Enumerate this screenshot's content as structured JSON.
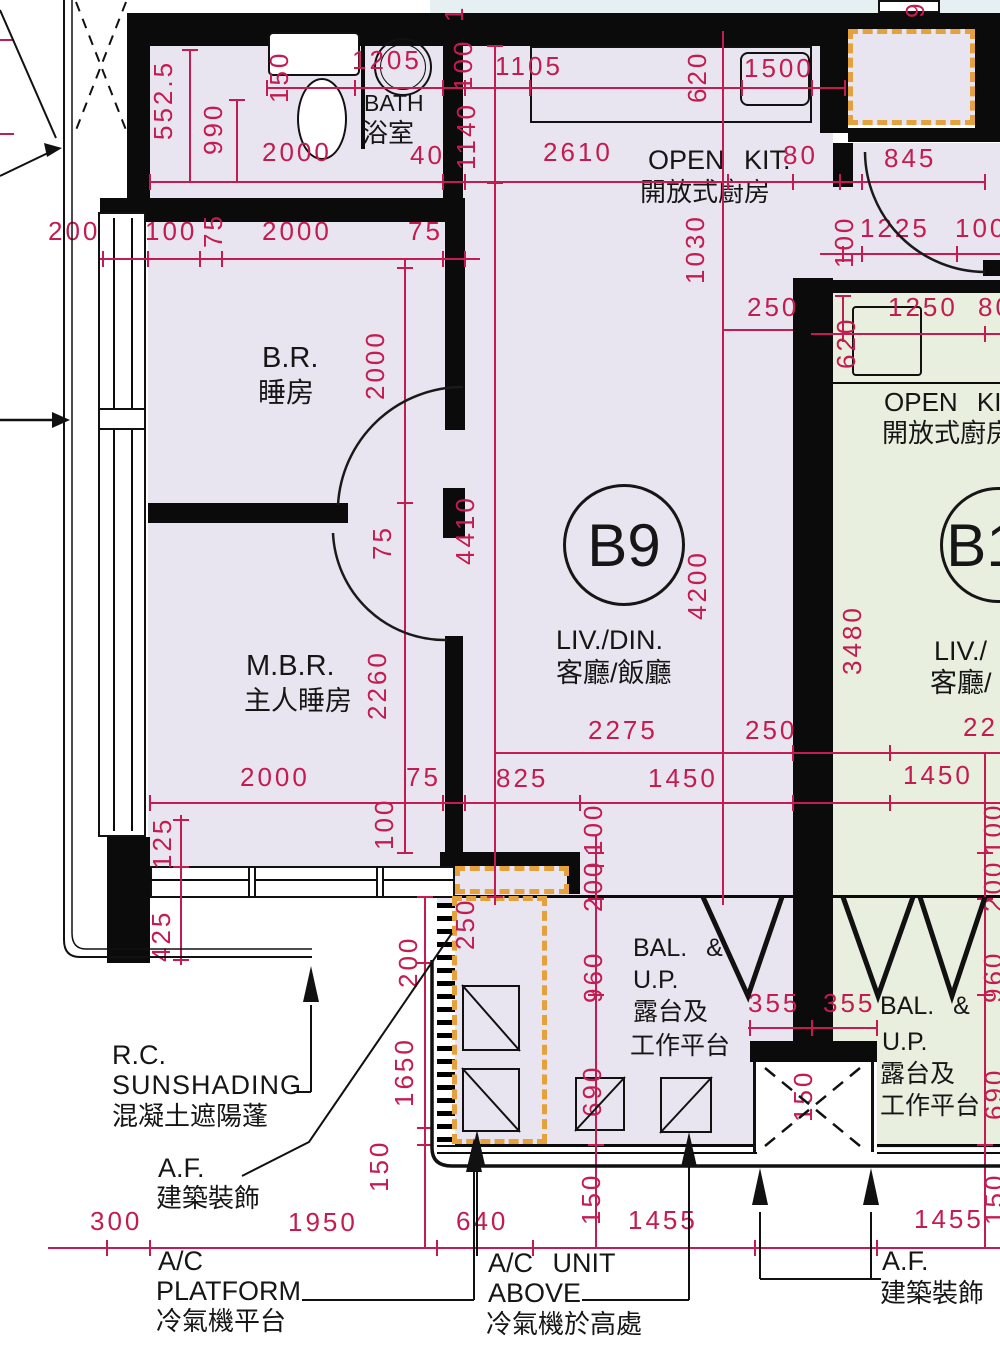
{
  "colors": {
    "dim_color": "#c41b50",
    "wall_color": "#0b0b0b",
    "unit_b9_fill": "#e9e5f0",
    "unit_b10_fill": "#e8efdf",
    "af_dashed_orange": "#e5a23c",
    "top_strip_fill": "#e6eff1"
  },
  "labels": {
    "bath_en": "BATH",
    "bath_zh": "浴室",
    "kit_en": "OPEN KIT.",
    "kit_zh": "開放式廚房",
    "kit2_en": "OPEN KIT",
    "kit2_zh": "開放式廚房",
    "br_en": "B.R.",
    "br_zh": "睡房",
    "mbr_en": "M.B.R.",
    "mbr_zh": "主人睡房",
    "unit1": "B9",
    "unit2": "B1",
    "liv1_en": "LIV./DIN.",
    "liv1_zh": "客廳/飯廳",
    "liv2_en": "LIV./",
    "liv2_zh": "客廳/",
    "bal_en1": "BAL. &",
    "bal_en2": "U.P.",
    "bal_zh1": "露台及",
    "bal_zh2": "工作平台",
    "rc1": "R.C.",
    "rc2": "SUNSHADING",
    "rc3": "混凝土遮陽蓬",
    "af_en": "A.F.",
    "af_zh": "建築裝飾",
    "acp1": "A/C",
    "acp2": "PLATFORM",
    "acp3": "冷氣機平台",
    "acu1": "A/C UNIT",
    "acu2": "ABOVE",
    "acu3": "冷氣機於高處"
  },
  "dims": {
    "v552_5": "552.5",
    "v990": "990",
    "v150": "150",
    "h1205": "1205",
    "v100a": "100",
    "h2000a": "2000",
    "h40": "40",
    "v1140": "1140",
    "h1105": "1105",
    "v620a": "620",
    "h1500": "1500",
    "h2610": "2610",
    "h80a": "80",
    "h845": "845",
    "v1030": "1030",
    "v100b": "100",
    "h1225": "1225",
    "h100a": "100",
    "h250a": "250",
    "h1250": "1250",
    "h80b": "80",
    "v620b": "620",
    "h200": "200",
    "h100b": "100",
    "v75a": "75",
    "h2000b": "2000",
    "h75a": "75",
    "v2000": "2000",
    "v4410": "4410",
    "v75b": "75",
    "v4200": "4200",
    "v3480": "3480",
    "v2260": "2260",
    "h2275": "2275",
    "h250b": "250",
    "h825": "825",
    "h1450a": "1450",
    "h1450b": "1450",
    "h22": "22",
    "h2000c": "2000",
    "h75b": "75",
    "v100c": "100",
    "v125": "125",
    "v425": "425",
    "v100d": "100",
    "v200a": "200",
    "v960a": "960",
    "v250": "250",
    "v200b": "200",
    "v1650": "1650",
    "v150b": "150",
    "v690a": "690",
    "v150c": "150",
    "h355a": "355",
    "h355b": "355",
    "v150d": "150",
    "v100e": "100",
    "v200c": "200",
    "v960b": "960",
    "v690b": "690",
    "v150e": "150",
    "h300": "300",
    "h1950": "1950",
    "h640": "640",
    "h1455a": "1455",
    "h1455b": "1455",
    "p1": "1",
    "p9": "9"
  }
}
